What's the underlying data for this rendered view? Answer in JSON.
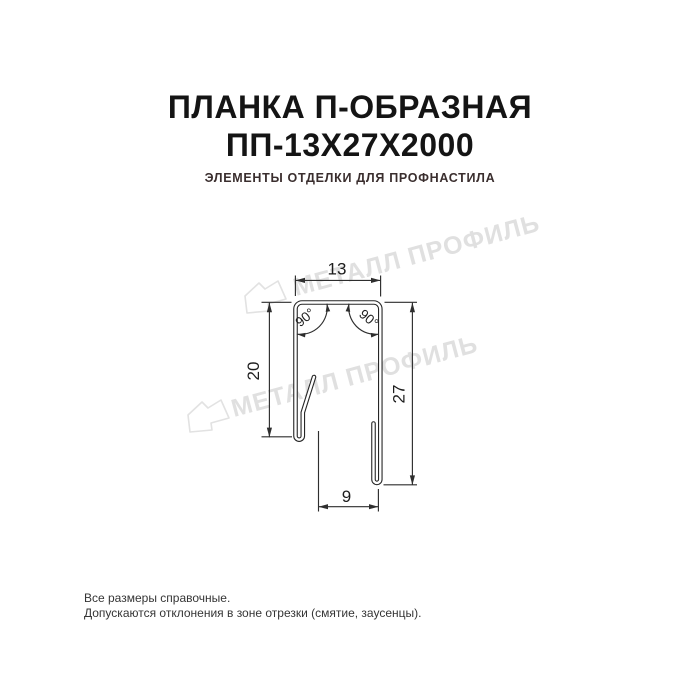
{
  "title": {
    "line1": "ПЛАНКА П-ОБРАЗНАЯ",
    "line2": "ПП-13Х27Х2000"
  },
  "subtitle": "ЭЛЕМЕНТЫ ОТДЕЛКИ ДЛЯ ПРОФНАСТИЛА",
  "watermark": {
    "text": "МЕТАЛЛ ПРОФИЛЬ"
  },
  "drawing": {
    "dimensions": {
      "top_width": "13",
      "left_height": "20",
      "right_height": "27",
      "bottom_width": "9",
      "angle_left": "90°",
      "angle_right": "90°"
    }
  },
  "footer": {
    "line1": "Все размеры справочные.",
    "line2": "Допускаются отклонения в зоне отрезки (смятие, заусенцы)."
  },
  "colors": {
    "title_text": "#141414",
    "subtitle_text": "#3a2e2e",
    "drawing_lines": "#262626",
    "watermark_gray": "#e0e0e0",
    "background": "#ffffff"
  }
}
